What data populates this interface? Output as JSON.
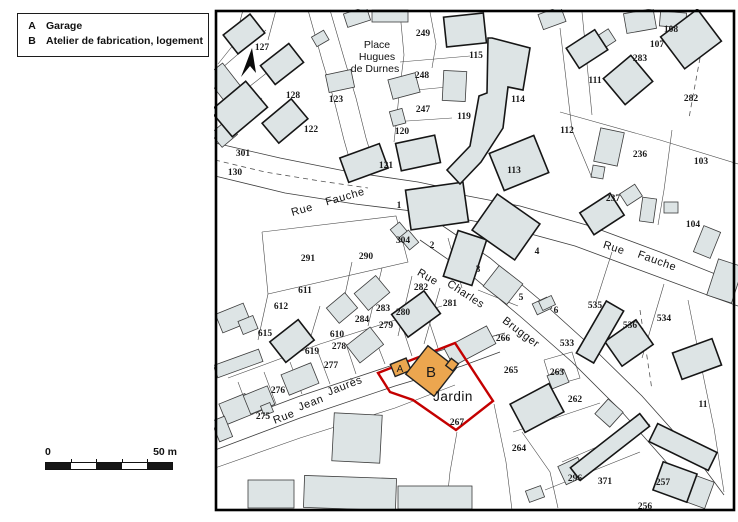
{
  "legend": {
    "items": [
      {
        "key": "A",
        "label": "Garage"
      },
      {
        "key": "B",
        "label": "Atelier de fabrication, logement"
      }
    ]
  },
  "scale_bar": {
    "start": "0",
    "end": "50 m"
  },
  "map": {
    "region_label": {
      "text": "Jardin",
      "x": 453,
      "y": 401
    },
    "building_labels": [
      {
        "text": "A",
        "x": 400,
        "y": 372,
        "size": 10
      },
      {
        "text": "B",
        "x": 431,
        "y": 377,
        "size": 15
      }
    ],
    "street_labels": [
      {
        "text": "Place",
        "x": 377,
        "y": 48,
        "rot": 0,
        "cls": "place-name"
      },
      {
        "text": "Hugues",
        "x": 377,
        "y": 60,
        "rot": 0,
        "cls": "place-name"
      },
      {
        "text": "de Durnes",
        "x": 375,
        "y": 72,
        "rot": 0,
        "cls": "place-name"
      },
      {
        "text": "Rue",
        "x": 303,
        "y": 213,
        "rot": -16,
        "cls": "street-name"
      },
      {
        "text": "Fauche",
        "x": 346,
        "y": 200,
        "rot": -16,
        "cls": "street-name"
      },
      {
        "text": "Rue",
        "x": 426,
        "y": 280,
        "rot": 30,
        "cls": "street-name"
      },
      {
        "text": "Charles",
        "x": 464,
        "y": 297,
        "rot": 33,
        "cls": "street-name"
      },
      {
        "text": "Brugger",
        "x": 519,
        "y": 335,
        "rot": 37,
        "cls": "street-name"
      },
      {
        "text": "Rue",
        "x": 613,
        "y": 251,
        "rot": 18,
        "cls": "street-name"
      },
      {
        "text": "Fauche",
        "x": 656,
        "y": 264,
        "rot": 20,
        "cls": "street-name"
      },
      {
        "text": "Rue",
        "x": 285,
        "y": 420,
        "rot": -21,
        "cls": "street-name"
      },
      {
        "text": "Jean",
        "x": 312,
        "y": 406,
        "rot": -21,
        "cls": "street-name"
      },
      {
        "text": "Jaurès",
        "x": 346,
        "y": 389,
        "rot": -21,
        "cls": "street-name"
      }
    ],
    "parcels": [
      {
        "n": "127",
        "x": 262,
        "y": 50
      },
      {
        "n": "128",
        "x": 293,
        "y": 98
      },
      {
        "n": "123",
        "x": 336,
        "y": 102
      },
      {
        "n": "122",
        "x": 311,
        "y": 132
      },
      {
        "n": "301",
        "x": 243,
        "y": 156
      },
      {
        "n": "130",
        "x": 235,
        "y": 175
      },
      {
        "n": "121",
        "x": 386,
        "y": 168
      },
      {
        "n": "249",
        "x": 423,
        "y": 36
      },
      {
        "n": "115",
        "x": 476,
        "y": 58
      },
      {
        "n": "248",
        "x": 422,
        "y": 78
      },
      {
        "n": "247",
        "x": 423,
        "y": 112
      },
      {
        "n": "119",
        "x": 464,
        "y": 119
      },
      {
        "n": "120",
        "x": 402,
        "y": 134
      },
      {
        "n": "114",
        "x": 518,
        "y": 102
      },
      {
        "n": "113",
        "x": 514,
        "y": 173
      },
      {
        "n": "108",
        "x": 671,
        "y": 32
      },
      {
        "n": "107",
        "x": 657,
        "y": 47
      },
      {
        "n": "283",
        "x": 640,
        "y": 61
      },
      {
        "n": "111",
        "x": 595,
        "y": 83
      },
      {
        "n": "282",
        "x": 691,
        "y": 101
      },
      {
        "n": "112",
        "x": 567,
        "y": 133
      },
      {
        "n": "236",
        "x": 640,
        "y": 157
      },
      {
        "n": "103",
        "x": 701,
        "y": 164
      },
      {
        "n": "237",
        "x": 613,
        "y": 201
      },
      {
        "n": "104",
        "x": 693,
        "y": 227
      },
      {
        "n": "1",
        "x": 399,
        "y": 208
      },
      {
        "n": "304",
        "x": 403,
        "y": 243
      },
      {
        "n": "2",
        "x": 432,
        "y": 248
      },
      {
        "n": "3",
        "x": 478,
        "y": 272
      },
      {
        "n": "4",
        "x": 537,
        "y": 254
      },
      {
        "n": "5",
        "x": 521,
        "y": 300
      },
      {
        "n": "6",
        "x": 556,
        "y": 313
      },
      {
        "n": "291",
        "x": 308,
        "y": 261
      },
      {
        "n": "290",
        "x": 366,
        "y": 259
      },
      {
        "n": "611",
        "x": 305,
        "y": 293
      },
      {
        "n": "612",
        "x": 281,
        "y": 309
      },
      {
        "n": "282",
        "x": 421,
        "y": 290
      },
      {
        "n": "281",
        "x": 450,
        "y": 306
      },
      {
        "n": "283",
        "x": 383,
        "y": 311
      },
      {
        "n": "280",
        "x": 403,
        "y": 315
      },
      {
        "n": "284",
        "x": 362,
        "y": 322
      },
      {
        "n": "279",
        "x": 386,
        "y": 328
      },
      {
        "n": "610",
        "x": 337,
        "y": 337
      },
      {
        "n": "278",
        "x": 339,
        "y": 349
      },
      {
        "n": "615",
        "x": 265,
        "y": 336
      },
      {
        "n": "619",
        "x": 312,
        "y": 354
      },
      {
        "n": "277",
        "x": 331,
        "y": 368
      },
      {
        "n": "276",
        "x": 278,
        "y": 393
      },
      {
        "n": "275",
        "x": 263,
        "y": 419
      },
      {
        "n": "535",
        "x": 595,
        "y": 308
      },
      {
        "n": "533",
        "x": 567,
        "y": 346
      },
      {
        "n": "536",
        "x": 630,
        "y": 328
      },
      {
        "n": "534",
        "x": 664,
        "y": 321
      },
      {
        "n": "266",
        "x": 503,
        "y": 341
      },
      {
        "n": "265",
        "x": 511,
        "y": 373
      },
      {
        "n": "263",
        "x": 557,
        "y": 375
      },
      {
        "n": "262",
        "x": 575,
        "y": 402
      },
      {
        "n": "267",
        "x": 457,
        "y": 425
      },
      {
        "n": "264",
        "x": 519,
        "y": 451
      },
      {
        "n": "296",
        "x": 575,
        "y": 481
      },
      {
        "n": "371",
        "x": 605,
        "y": 484
      },
      {
        "n": "257",
        "x": 663,
        "y": 485
      },
      {
        "n": "256",
        "x": 645,
        "y": 509
      },
      {
        "n": "11",
        "x": 703,
        "y": 407
      }
    ],
    "colors": {
      "building_fill": "#dde4e5",
      "building_stroke": "#2b2b2b",
      "parcel_line": "#4a4a4a",
      "boundary_red": "#c40000",
      "highlight_orange": "#eca64f",
      "map_border": "#000000",
      "label_color": "#1a1a1a"
    }
  }
}
